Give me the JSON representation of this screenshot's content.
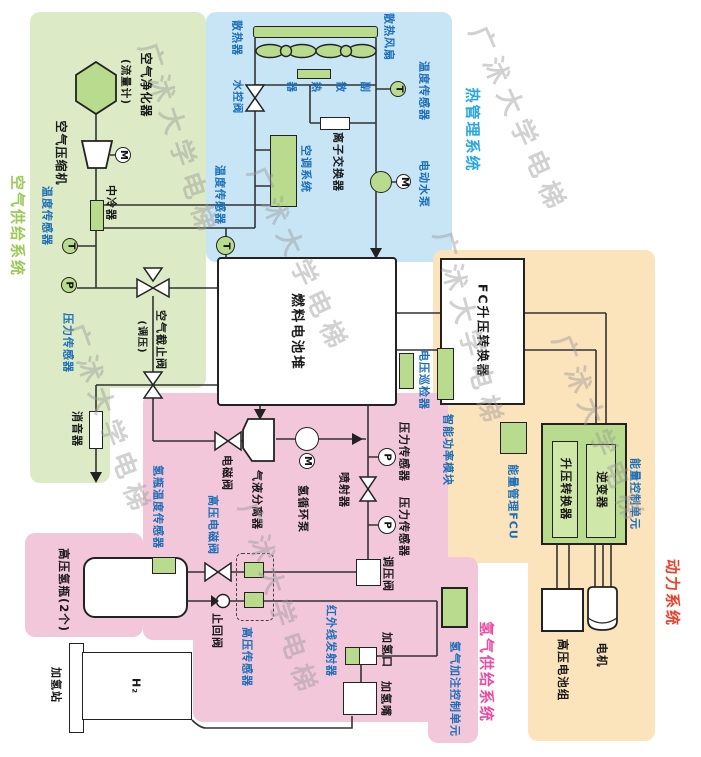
{
  "badges": {
    "t": "T",
    "p": "P",
    "m": "M"
  },
  "air": {
    "title": "空气供给系统",
    "purifier": "空气净化器",
    "flow_meter": "(流量计)",
    "compressor": "空气压缩机",
    "intercooler": "中冷器",
    "temp_sensor": "温度传感器",
    "pressure_sensor": "压力传感器",
    "shutoff_valve": "空气截止阀",
    "shutoff_valve_note": "(调压)",
    "muffler": "消音器"
  },
  "thermal": {
    "title": "热管理系统",
    "radiator": "散热器",
    "cooling_fan": "散热风扇",
    "aux_radiator": "副散热器",
    "water_valve": "水控阀",
    "ion_exchanger": "离子交换器",
    "ac_system": "空调系统",
    "temp_sensor_in": "温度传感器",
    "temp_sensor_out": "温度传感器",
    "water_pump": "电动水泵"
  },
  "stack": {
    "name": "燃料电池堆"
  },
  "hydrogen": {
    "title": "氢气供给系统",
    "purge_valve": "电磁阀",
    "separator": "气液分离器",
    "circulation_pump": "氢循环泵",
    "injector": "喷射器",
    "pressure_sensor_high": "压力传感器",
    "pressure_sensor_low": "压力传感器",
    "regulator": "调压阀",
    "bottle_temp_sensor": "氢瓶温度传感器",
    "hp_solenoid": "高压电磁阀",
    "bottles": "高压氢瓶(2个)",
    "check_valve": "止回阀",
    "hp_sensor": "高压传感器",
    "ir_transmitter": "红外线发射器",
    "fill_port": "加氢口",
    "fill_nozzle": "加氢嘴",
    "station": "加氢站",
    "h2": "H₂",
    "fill_control": "氢气加注控制单元"
  },
  "power": {
    "title": "动力系统",
    "fc_converter": "FC升压转换器",
    "voltage_monitor": "电压巡检器",
    "power_module": "智能功率模块",
    "energy_fcu": "能量管理FCU",
    "energy_control": "能量控制单元",
    "boost_converter": "升压转换器",
    "inverter": "逆变器",
    "battery": "高压电池组",
    "motor": "电机"
  },
  "watermark": {
    "text": "广沭大学电梯"
  },
  "colors": {
    "air_bg": "#dcebc5",
    "thermal_bg": "#c8e5f6",
    "hydrogen_bg": "#f3c7da",
    "power_bg": "#fbe3bb",
    "component": "#b9db8d",
    "air_title": "#9cc957",
    "thermal_title": "#2ba7de",
    "hydrogen_title": "#e74ea4",
    "power_title": "#e8432c",
    "sensor_label": "#1c6eb8"
  }
}
